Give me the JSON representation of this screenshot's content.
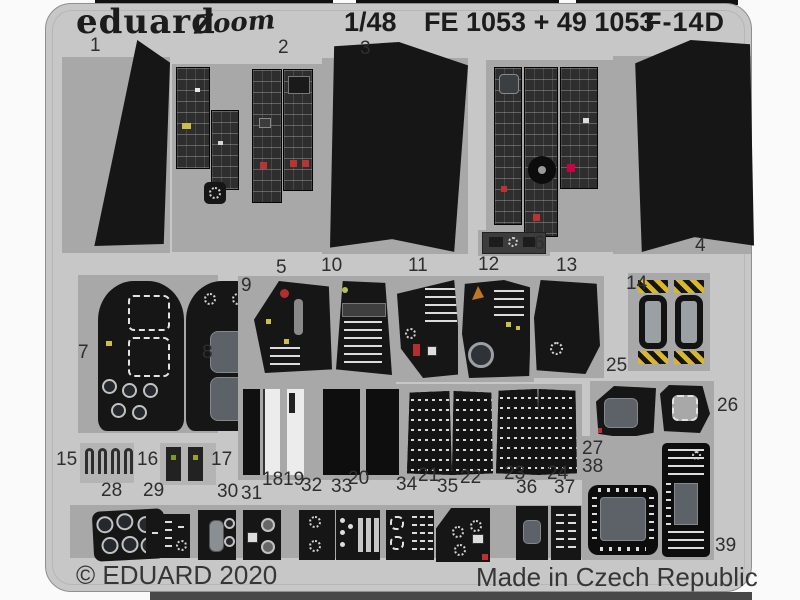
{
  "header": {
    "brand": "eduard",
    "series": "Zoom",
    "scale": "1/48",
    "product_codes": "FE 1053 + 49 1053",
    "aircraft": "F-14D"
  },
  "footer": {
    "copyright": "© EDUARD 2020",
    "made_in": "Made in Czech Republic"
  },
  "colors": {
    "sheet": "#c7c7c7",
    "recess": "#a8a8a8",
    "part": "#161616",
    "screen": "#5d6268",
    "stripe": "#d8b82a"
  },
  "parts": [
    {
      "n": "1",
      "x": 90,
      "y": 36
    },
    {
      "n": "2",
      "x": 278,
      "y": 38
    },
    {
      "n": "3",
      "x": 360,
      "y": 39
    },
    {
      "n": "4",
      "x": 695,
      "y": 236
    },
    {
      "n": "5",
      "x": 276,
      "y": 258
    },
    {
      "n": "6",
      "x": 534,
      "y": 234
    },
    {
      "n": "7",
      "x": 78,
      "y": 343
    },
    {
      "n": "8",
      "x": 202,
      "y": 343
    },
    {
      "n": "9",
      "x": 241,
      "y": 276
    },
    {
      "n": "10",
      "x": 321,
      "y": 256
    },
    {
      "n": "11",
      "x": 408,
      "y": 256
    },
    {
      "n": "12",
      "x": 478,
      "y": 255
    },
    {
      "n": "13",
      "x": 556,
      "y": 256
    },
    {
      "n": "14",
      "x": 626,
      "y": 274
    },
    {
      "n": "15",
      "x": 56,
      "y": 450
    },
    {
      "n": "16",
      "x": 137,
      "y": 450
    },
    {
      "n": "17",
      "x": 211,
      "y": 450
    },
    {
      "n": "18",
      "x": 262,
      "y": 470
    },
    {
      "n": "19",
      "x": 283,
      "y": 470
    },
    {
      "n": "20",
      "x": 348,
      "y": 469
    },
    {
      "n": "21",
      "x": 418,
      "y": 466
    },
    {
      "n": "22",
      "x": 460,
      "y": 468
    },
    {
      "n": "23",
      "x": 504,
      "y": 464
    },
    {
      "n": "24",
      "x": 547,
      "y": 464
    },
    {
      "n": "25",
      "x": 606,
      "y": 356
    },
    {
      "n": "26",
      "x": 717,
      "y": 396
    },
    {
      "n": "27",
      "x": 582,
      "y": 439
    },
    {
      "n": "28",
      "x": 101,
      "y": 481
    },
    {
      "n": "29",
      "x": 143,
      "y": 481
    },
    {
      "n": "30",
      "x": 217,
      "y": 482
    },
    {
      "n": "31",
      "x": 241,
      "y": 484
    },
    {
      "n": "32",
      "x": 301,
      "y": 476
    },
    {
      "n": "33",
      "x": 331,
      "y": 477
    },
    {
      "n": "34",
      "x": 396,
      "y": 475
    },
    {
      "n": "35",
      "x": 437,
      "y": 477
    },
    {
      "n": "36",
      "x": 516,
      "y": 478
    },
    {
      "n": "37",
      "x": 554,
      "y": 478
    },
    {
      "n": "38",
      "x": 582,
      "y": 457
    },
    {
      "n": "39",
      "x": 715,
      "y": 536
    }
  ]
}
